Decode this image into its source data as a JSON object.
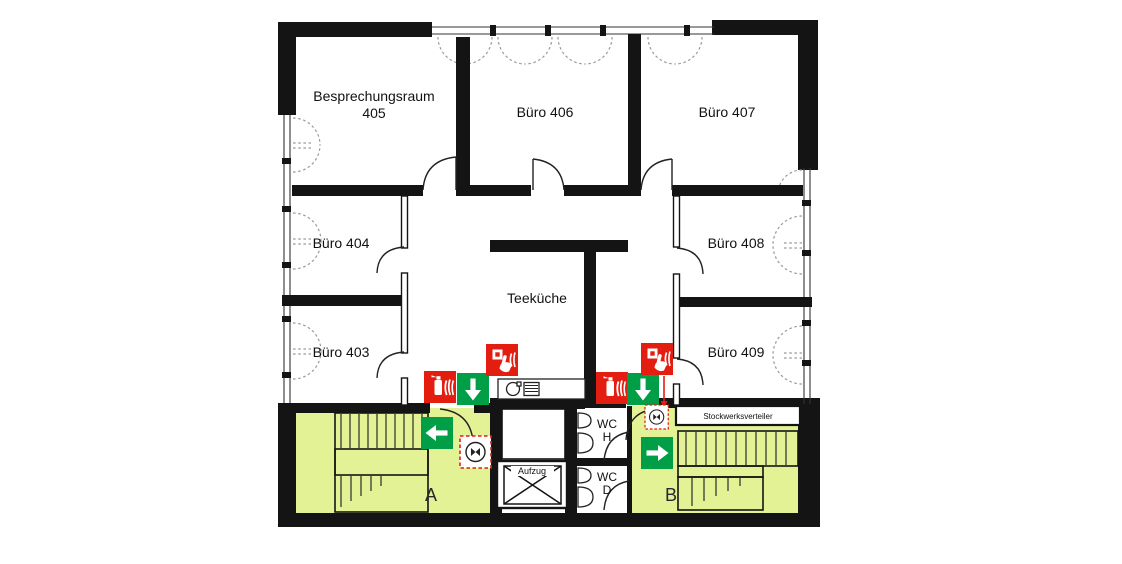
{
  "plan_title": "Fluchtplan Obergeschoss (escape floor plan)",
  "rooms": {
    "meeting": {
      "line1": "Besprechungsraum",
      "line2": "405"
    },
    "b406": "Büro 406",
    "b407": "Büro 407",
    "b404": "Büro 404",
    "b403": "Büro 403",
    "b408": "Büro 408",
    "b409": "Büro 409",
    "teekueche": "Teeküche",
    "wc_h": {
      "line1": "WC",
      "line2": "H"
    },
    "wc_d": {
      "line1": "WC",
      "line2": "D"
    },
    "aufzug": "Aufzug",
    "verteiler": "Stockwerksverteiler",
    "stairwell_a": "A",
    "stairwell_b": "B"
  },
  "icons": {
    "fire_extinguisher": "fire-extinguisher",
    "manual_call_point": "manual-call-point",
    "escape_arrow_down": "escape-route-down-arrow",
    "escape_arrow_left": "escape-route-left-arrow",
    "escape_arrow_right": "escape-route-right-arrow",
    "alarm_device": "alarm-sounder-symbol",
    "kitchenette": "sink-and-stove-symbol",
    "elevator_cross": "elevator-shaft-cross"
  },
  "colors": {
    "safety_red": "#e31e10",
    "escape_green": "#009f47",
    "stairwell_fill": "#e3f295",
    "wall_black": "#141414"
  }
}
